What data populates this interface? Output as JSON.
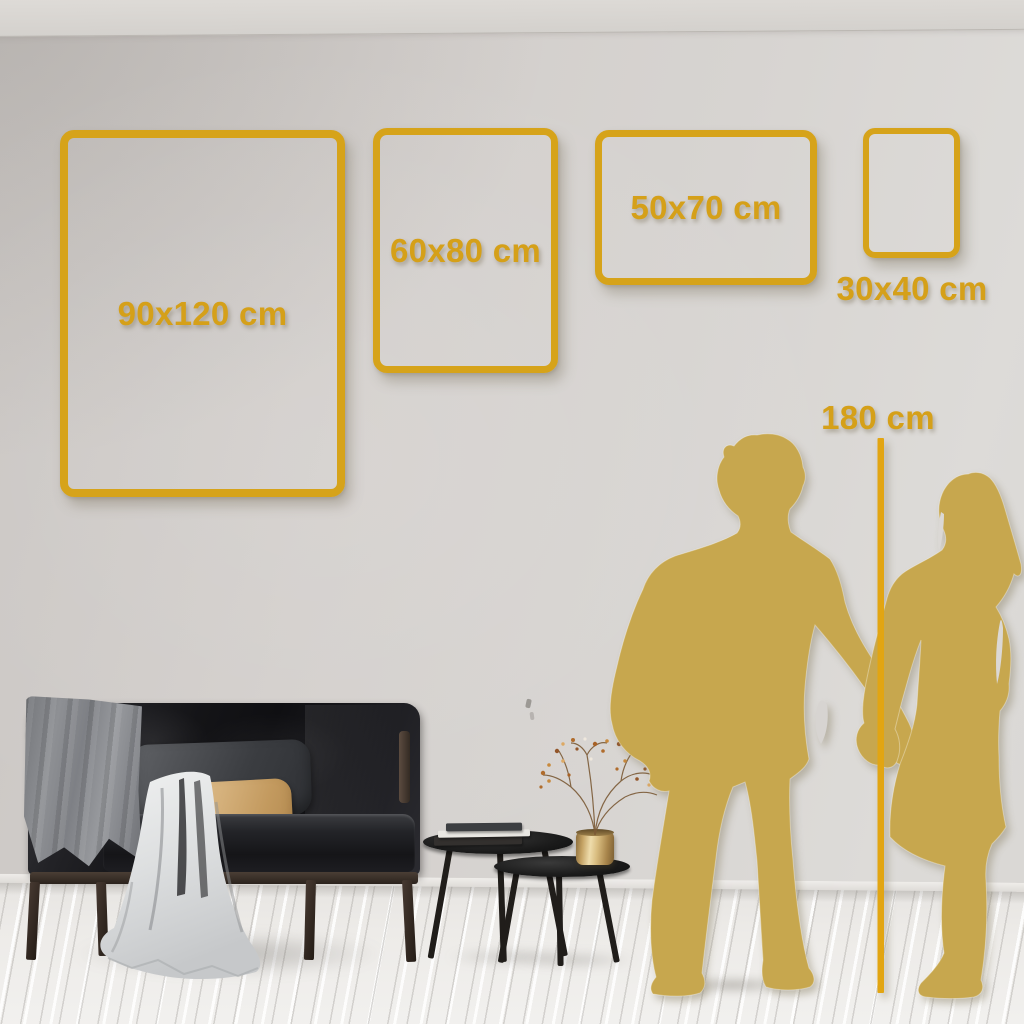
{
  "scene": {
    "type": "poster-size-comparison-room",
    "wall_color": "#d3cfcc",
    "floor_color": "#edebe8"
  },
  "frames": [
    {
      "id": "90x120",
      "label": "90x120 cm",
      "orientation": "portrait"
    },
    {
      "id": "60x80",
      "label": "60x80 cm",
      "orientation": "portrait"
    },
    {
      "id": "50x70",
      "label": "50x70 cm",
      "orientation": "landscape"
    },
    {
      "id": "30x40",
      "label": "30x40 cm",
      "orientation": "portrait"
    }
  ],
  "height_marker": {
    "label": "180 cm"
  },
  "colors": {
    "frame_gold": "#d6a31a",
    "label_gold": "#d5a019",
    "line_gold": "#e2a512",
    "silhouette_gold": "#c7a74e"
  },
  "decor": {
    "sofa": "dark-velvet-loveseat",
    "gray_blanket": "armrest-blanket",
    "white_throw": "cascading-throw",
    "dark_pillow": "charcoal-pillow",
    "tan_pillow": "beige-lumbar-pillow",
    "coffee_tables": "round-nesting-tables",
    "books": "stacked-books",
    "vase": "brass-vase-dried-branches",
    "silhouettes": "couple-holding-hands"
  }
}
